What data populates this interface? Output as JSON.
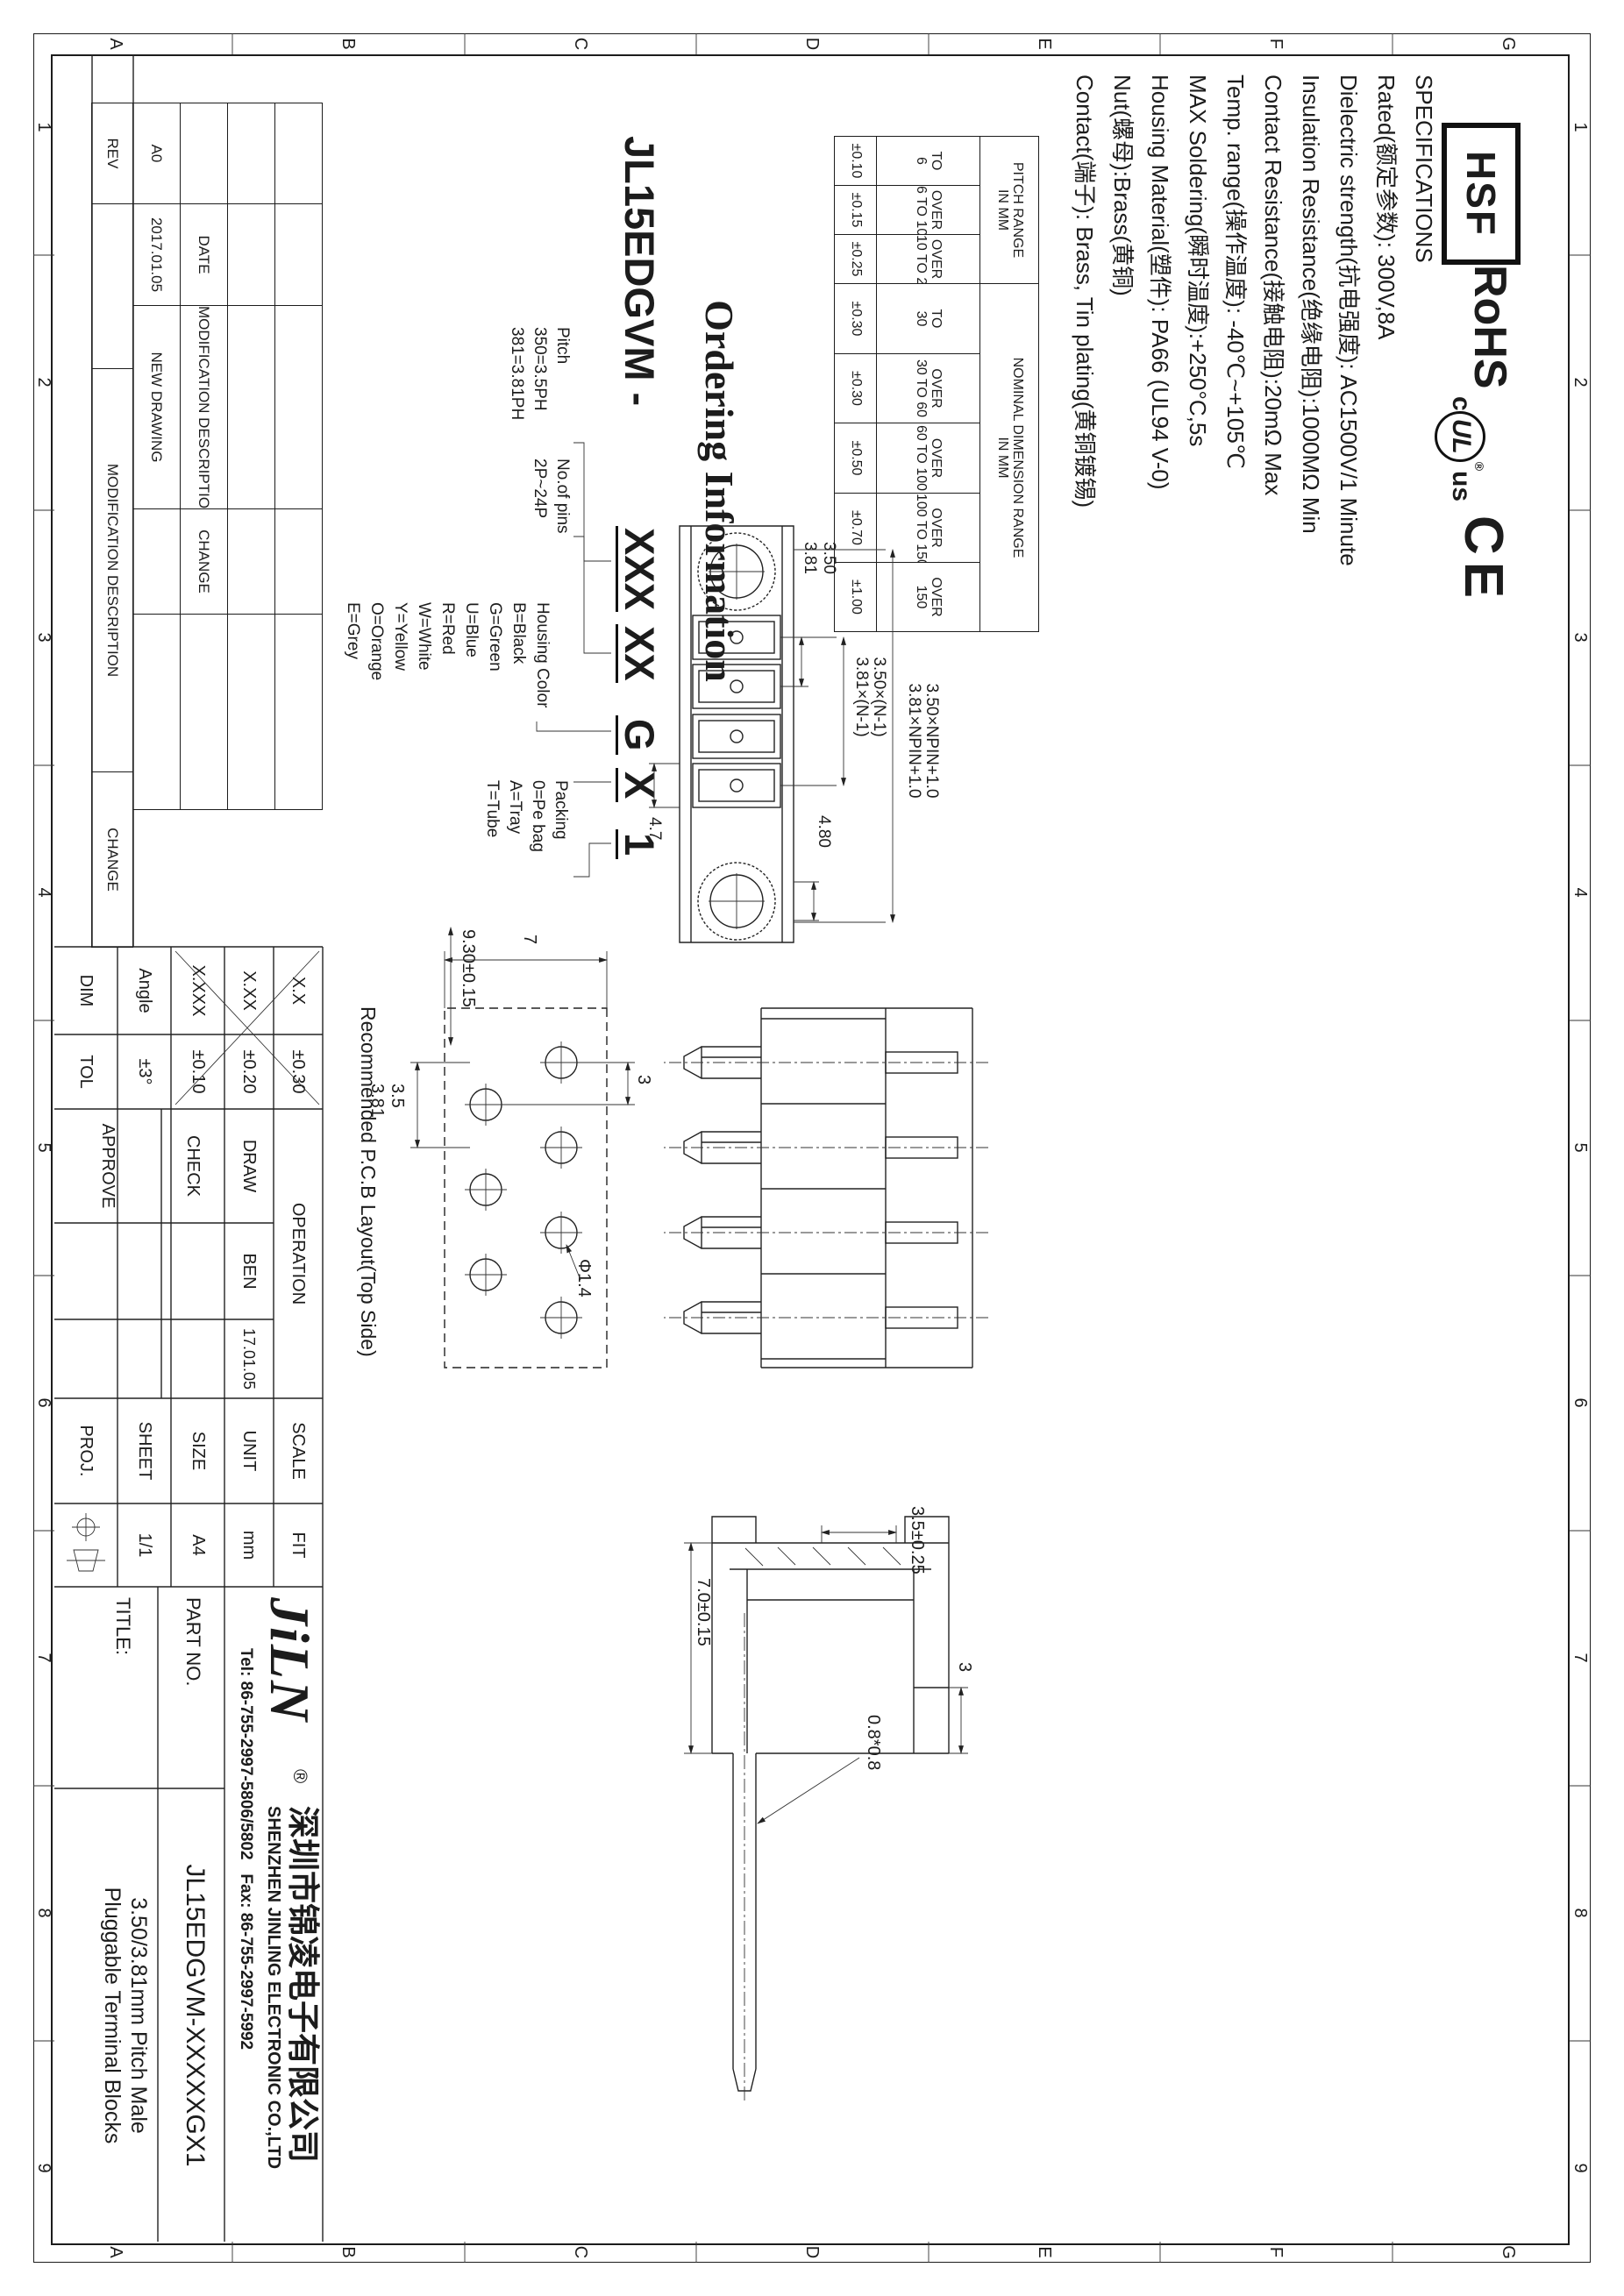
{
  "sheet": {
    "zones_letters": [
      "G",
      "F",
      "E",
      "D",
      "C",
      "B",
      "A"
    ],
    "zones_numbers": [
      "1",
      "2",
      "3",
      "4",
      "5",
      "6",
      "7",
      "8",
      "9"
    ]
  },
  "logos": {
    "hsf": "HSF",
    "rohs": "RoHS",
    "ul_c": "c",
    "ul": "UL",
    "ul_us": "us",
    "ul_r": "®",
    "ce": "CE"
  },
  "specs": {
    "lines": [
      "SPECIFICATIONS",
      "Rated(额定参数): 300V,8A",
      "Dielectric strength(抗电强度): AC1500V/1 Minute",
      "Insulation Resistance(绝缘电阻):1000MΩ Min",
      "Contact Resistance(接触电阻):20mΩ Max",
      "Temp. range(操作温度): -40℃~+105℃",
      "MAX Soldering(瞬时温度):+250°C,5s",
      "Housing Material(塑件): PA66 (UL94 V-0)",
      "Nut(螺母):Brass(黄铜)",
      "Contact(端子): Brass, Tin plating(黄铜镀锡)"
    ]
  },
  "dim_table": {
    "pitch_header_line1": "PITCH RANGE",
    "pitch_header_line2": "IN MM",
    "nominal_header_line1": "NOMINAL DIMENSION RANGE",
    "nominal_header_line2": "IN MM",
    "cols": [
      {
        "r1": "TO",
        "r2": "6",
        "tol": "±0.10"
      },
      {
        "r1": "OVER",
        "r2": "6 TO 10",
        "tol": "±0.15"
      },
      {
        "r1": "OVER",
        "r2": "10 TO 24",
        "tol": "±0.25"
      },
      {
        "r1": "TO",
        "r2": "30",
        "tol": "±0.30"
      },
      {
        "r1": "OVER",
        "r2": "30 TO 60",
        "tol": "±0.30"
      },
      {
        "r1": "OVER",
        "r2": "60 TO 100",
        "tol": "±0.50"
      },
      {
        "r1": "OVER",
        "r2": "100 TO 150",
        "tol": "±0.70"
      },
      {
        "r1": "OVER",
        "r2": "150",
        "tol": "±1.00"
      }
    ]
  },
  "ordering": {
    "title": "Ordering Information",
    "base": "JL15EDGVM -",
    "code_pitch": "XXX",
    "code_pins": "XX",
    "code_color": "G",
    "code_packing1": "X",
    "code_packing2": "1",
    "pitch_lines": [
      "Pitch",
      "350=3.5PH",
      "381=3.81PH"
    ],
    "pins_lines": [
      "No.of pins",
      "2P~24P"
    ],
    "color_lines": [
      "Housing Color",
      "B=Black",
      "G=Green",
      "U=Blue",
      "R=Red",
      "W=White",
      "Y=Yellow",
      "O=Orange",
      "E=Grey"
    ],
    "packing_lines": [
      "Packing",
      "0=Pe bag",
      "A=Tray",
      "T=Tube"
    ]
  },
  "front_view": {
    "dim_overall_1": "3.50×NPIN+1.0",
    "dim_overall_2": "3.81×NPIN+1.0",
    "dim_span_1": "3.50×(N-1)",
    "dim_span_2": "3.81×(N-1)",
    "dim_pitch_1": "3.50",
    "dim_pitch_2": "3.81",
    "dim_width": "4.7",
    "dim_flange": "4.80"
  },
  "pcb": {
    "caption": "Recommended P.C.B Layout(Top Side)",
    "dim_height": "7",
    "dim_offset": "3",
    "dim_hole": "Φ1.4",
    "dim_pitch_1": "3.5",
    "dim_pitch_2": "3.81",
    "dim_length": "9.30±0.15"
  },
  "profile": {
    "dim_width": "7.0±0.15",
    "dim_pin": "0.8*0.8",
    "dim_h": "3.5±0.25",
    "dim_step": "3"
  },
  "rev": {
    "header": [
      "",
      "DATE",
      "MODIFICATION DESCRIPTION",
      "CHANGE"
    ],
    "entry": [
      "A0",
      "2017.01.05",
      "NEW DRAWING",
      ""
    ],
    "strip": [
      "REV",
      "",
      "MODIFICATION DESCRIPTION",
      "CHANGE"
    ]
  },
  "tol_grid": {
    "rows": [
      [
        "X.X",
        "±0.30"
      ],
      [
        "X.XX",
        "±0.20"
      ],
      [
        "X.XXX",
        "±0.10"
      ],
      [
        "Angle",
        "±3°"
      ],
      [
        "DIM",
        "TOL"
      ]
    ]
  },
  "op": {
    "header": "OPERATION",
    "r1": [
      "DRAW",
      "BEN",
      "17.01.05"
    ],
    "r2": "CHECK",
    "r3": "APPROVE"
  },
  "scale_block": {
    "rows": [
      [
        "SCALE",
        "FIT"
      ],
      [
        "UNIT",
        "mm"
      ],
      [
        "SIZE",
        "A4"
      ],
      [
        "SHEET",
        "1/1"
      ],
      [
        "PROJ.",
        ""
      ]
    ]
  },
  "company": {
    "logo": "JiLN",
    "reg": "®",
    "name_cn": "深圳市锦凌电子有限公司",
    "name_en": "SHENZHEN JINLING ELECTRONIC CO.,LTD",
    "tel": "Tel: 86-755-2997-5806/5802",
    "fax": "Fax: 86-755-2997-5992"
  },
  "title_block": {
    "part_label": "PART NO.",
    "part_value": "JL15EDGVM-XXXXXGX1",
    "title_label": "TITLE:",
    "title_value_1": "3.50/3.81mm Pitch Male",
    "title_value_2": "Pluggable Terminal Blocks"
  }
}
